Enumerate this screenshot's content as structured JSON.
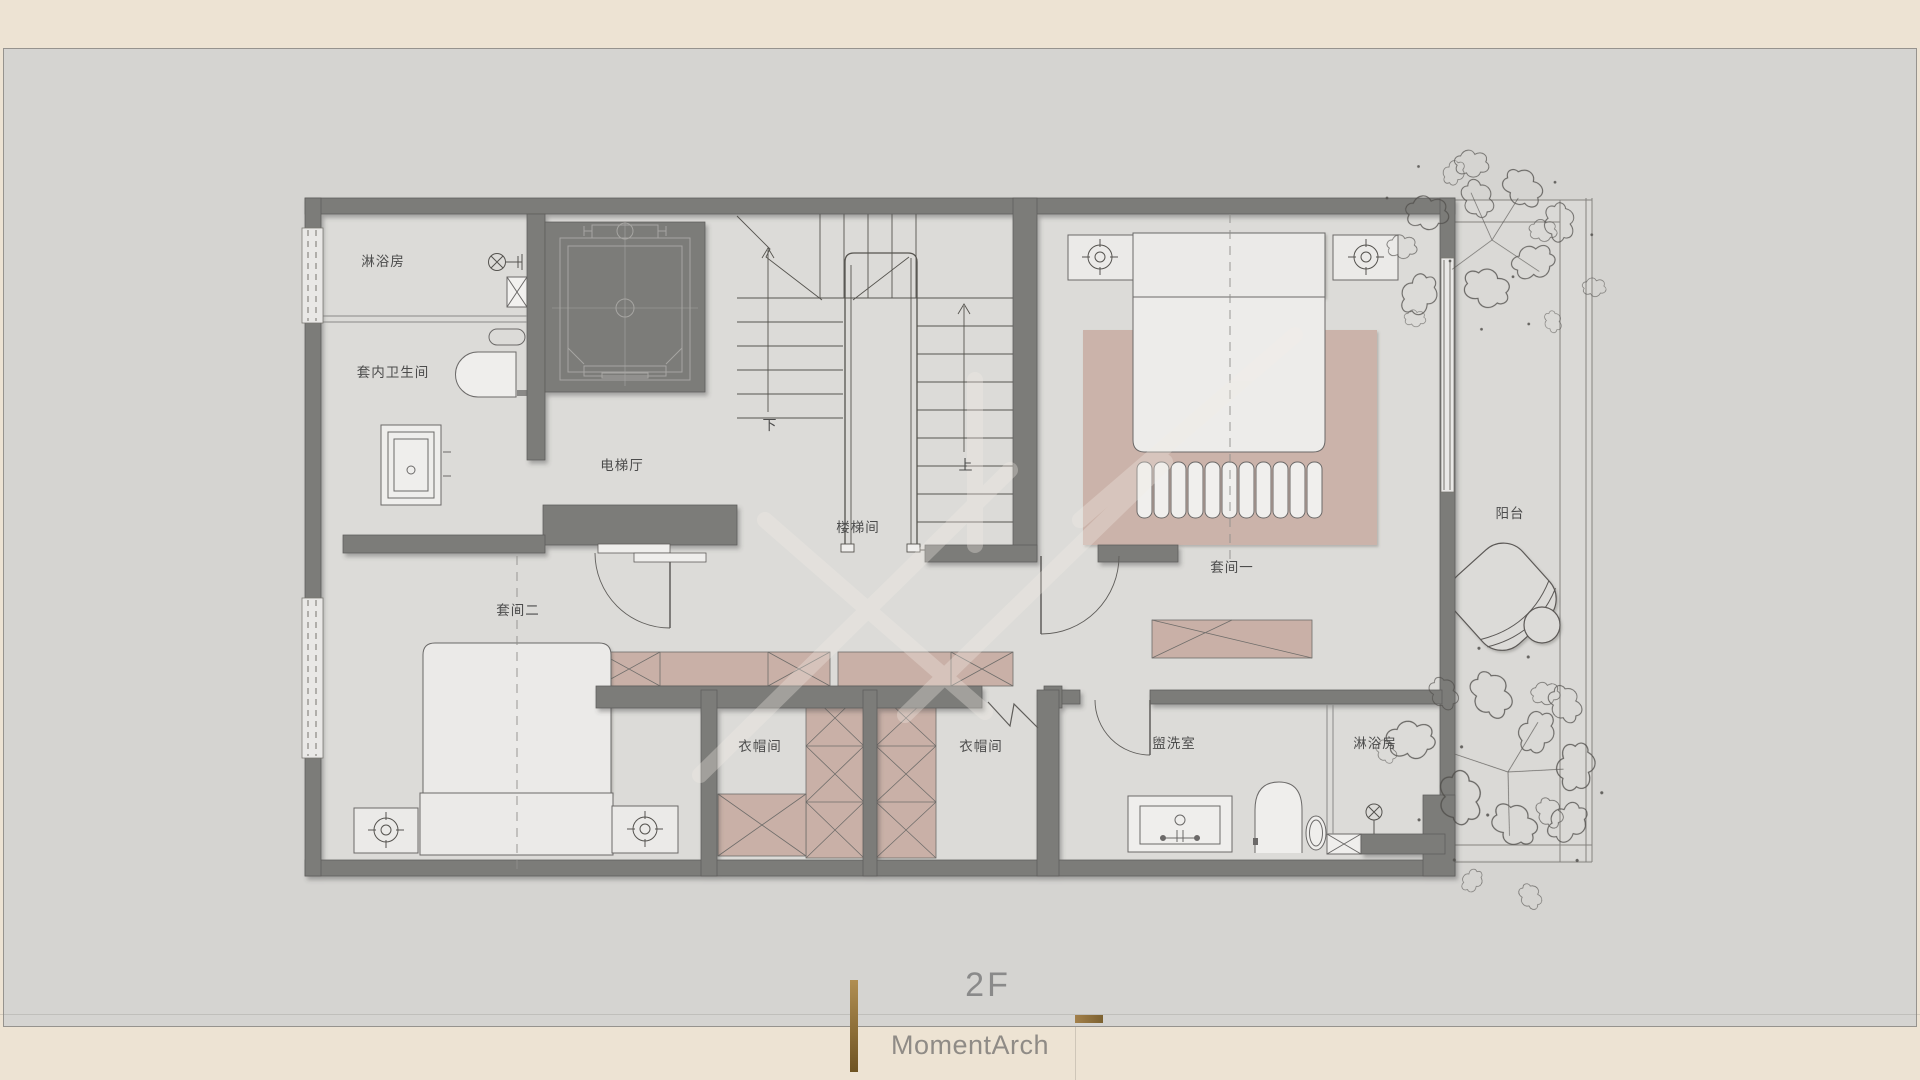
{
  "page": {
    "floor_label": "2F",
    "brand": "MomentArch"
  },
  "plan": {
    "rooms": [
      {
        "name": "shower-room-upper",
        "label": "淋浴房"
      },
      {
        "name": "ensuite-bathroom",
        "label": "套内卫生间"
      },
      {
        "name": "elevator-hall",
        "label": "电梯厅"
      },
      {
        "name": "stairwell",
        "label": "楼梯间"
      },
      {
        "name": "suite-one",
        "label": "套间一"
      },
      {
        "name": "suite-two",
        "label": "套间二"
      },
      {
        "name": "cloakroom-left",
        "label": "衣帽间"
      },
      {
        "name": "cloakroom-right",
        "label": "衣帽间"
      },
      {
        "name": "washroom",
        "label": "盥洗室"
      },
      {
        "name": "shower-room-lower",
        "label": "淋浴房"
      },
      {
        "name": "balcony",
        "label": "阳台"
      }
    ],
    "stair_annotations": {
      "down": "下",
      "up": "上"
    }
  },
  "colors": {
    "paper_cream": "#EDE3D3",
    "canvas_gray": "#D5D4D1",
    "wall_gray": "#7C7B79",
    "furniture_pink": "#CBB3AA",
    "gold_accent": "#8F7133",
    "label_ink": "#4C4C4C",
    "title_gray": "#8A8A8A"
  }
}
